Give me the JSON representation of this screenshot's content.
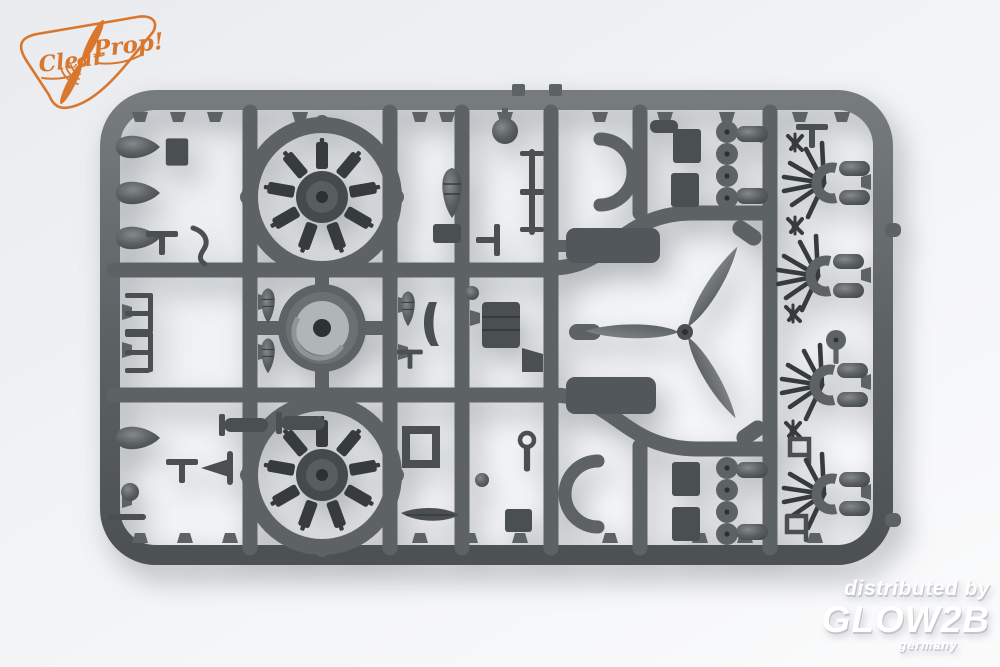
{
  "photo_subject": "injection-molded model kit sprue with aircraft engine and propeller parts",
  "logo": {
    "brand": "Clear Prop!",
    "text_clear": "Clear",
    "text_prop": "Prop!"
  },
  "watermark": {
    "distributed_by": "distributed by",
    "brand": "GLOW2B",
    "country": "germany"
  },
  "colors": {
    "plastic": "#5d6364",
    "plastic_dark": "#4a5051",
    "plastic_darker": "#363b3d",
    "plastic_light": "#7d8384",
    "cowl_light": "#b0b5b5",
    "hole_dark": "#2c3133",
    "accent": "#d9772e",
    "watermark_color": "#ffffff",
    "bg_top": "#e9ebee",
    "bg_bottom": "#fbfbfc"
  },
  "sprue_parts": [
    {
      "name": "radial-engine",
      "count": 2
    },
    {
      "name": "engine-cowling-ring",
      "count": 1
    },
    {
      "name": "three-blade-propeller",
      "count": 1
    },
    {
      "name": "exhaust-spider",
      "count": 4
    },
    {
      "name": "wheel-disc",
      "count": 8
    },
    {
      "name": "teardrop-tank",
      "count": 6
    },
    {
      "name": "half-ring-cowl-section",
      "count": 2
    },
    {
      "name": "torpedo-fairing",
      "count": 2
    },
    {
      "name": "square-plate",
      "count": 4
    },
    {
      "name": "square-frame-part",
      "count": 1
    },
    {
      "name": "small-brackets-and-pegs",
      "count": 40
    }
  ]
}
